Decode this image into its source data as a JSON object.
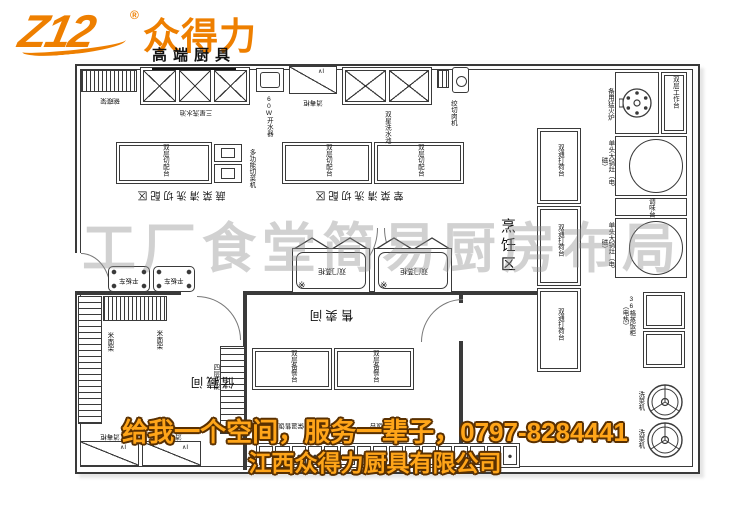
{
  "logo": {
    "mark": "Z12",
    "reg": "®",
    "brand": "众得力",
    "tagline": "高端厨具"
  },
  "watermark": "工厂食堂简易厨房布局",
  "banner": {
    "line1": "给我一个空间，服务一辈子，0797-8284441",
    "line2": "江西众得力厨具有限公司"
  },
  "colors": {
    "accent": "#ee7f00",
    "banner_text": "#ffa519",
    "banner_stroke": "#5a3000",
    "line": "#3a3a3a"
  },
  "areas": {
    "veg": "蔬菜清洗切配区",
    "meat": "荤菜清洗切配区",
    "cooking": "烹饪区",
    "storage": "储藏间",
    "sale": "售卖间"
  },
  "equipment": {
    "dish_rack": "碗碟架",
    "sink3": "三星洗水池",
    "boiler": "60W开水器",
    "disinfect": "消毒柜",
    "sink2": "双星洗水池",
    "grinder": "绞切肉机",
    "spare_burner": "备用猛火炉",
    "worktable": "双层工作台",
    "wok": "单头大锅灶（电磁）",
    "seasoning": "调味台",
    "steamer36": "36格蒸饭柜（电热）",
    "veg_washer": "洗菜机",
    "passtable": "双通打荷台",
    "cuttable": "双层切配台",
    "veg_cutter": "多功能切菜机",
    "steam_cab": "双门蒸柜",
    "steam_mark": "※",
    "shelf_mark": "∧I",
    "cart": "平板车",
    "rice_rack": "米面架",
    "shelf4": "四层货架",
    "preptable": "双层备餐台",
    "servetable": "保温售饭台"
  }
}
